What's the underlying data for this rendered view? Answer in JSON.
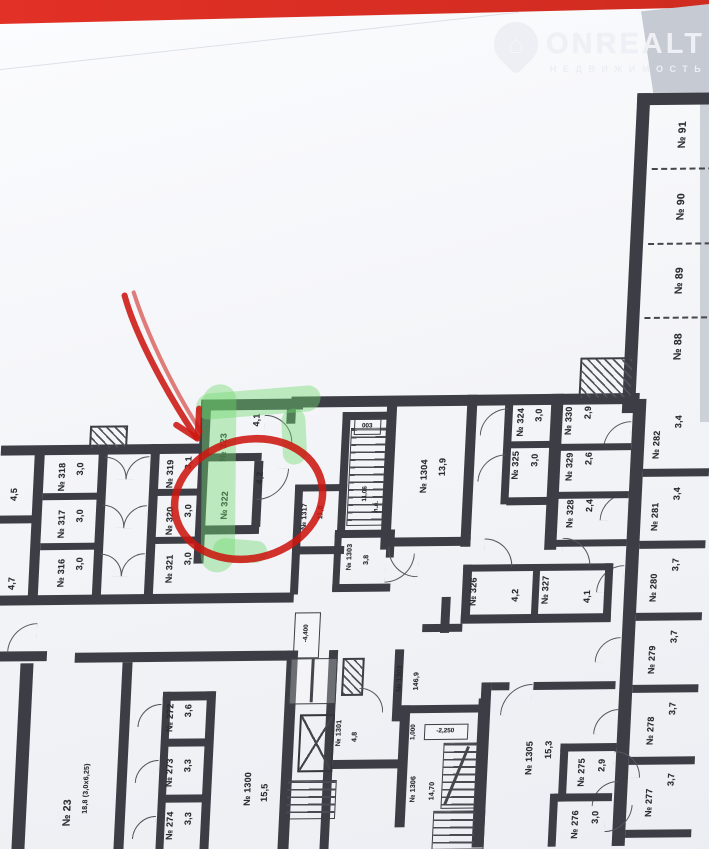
{
  "photo": {
    "top_strip_color": "#e23126",
    "background_color": "#c6cad2",
    "paper_color": "#f4f5f8"
  },
  "watermark": {
    "brand": "ONREALT",
    "subtitle": "НЕДВИЖИМОСТЬ"
  },
  "annotations": {
    "highlight_color": "#6fd96f",
    "marker_color": "#cc1710",
    "target_room": "№ 322"
  },
  "floorplan": {
    "rooms": {
      "r91": {
        "num": "№ 91"
      },
      "r90": {
        "num": "№ 90"
      },
      "r89": {
        "num": "№ 89"
      },
      "r88": {
        "num": "№ 88"
      },
      "r282": {
        "num": "№ 282",
        "area": "3,4"
      },
      "r281": {
        "num": "№ 281",
        "area": "3,4"
      },
      "r280": {
        "num": "№ 280",
        "area": "3,7"
      },
      "r279": {
        "num": "№ 279",
        "area": "3,7"
      },
      "r278": {
        "num": "№ 278",
        "area": "3,7"
      },
      "r277": {
        "num": "№ 277",
        "area": "3,7"
      },
      "r330": {
        "num": "№ 330",
        "area": "2,9"
      },
      "r329": {
        "num": "№ 329",
        "area": "2,6"
      },
      "r328": {
        "num": "№ 328",
        "area": "2,4"
      },
      "r324": {
        "num": "№ 324",
        "area": "3,0"
      },
      "r325": {
        "num": "№ 325",
        "area": "3,0"
      },
      "r326": {
        "num": "№ 326",
        "area": "4,2"
      },
      "r327": {
        "num": "№ 327",
        "area": "4,1"
      },
      "r323": {
        "num": "№ 323",
        "area": "4,1"
      },
      "r322": {
        "num": "№ 322",
        "area": "4,2"
      },
      "r319": {
        "num": "№ 319",
        "area": "3,1"
      },
      "r320": {
        "num": "№ 320",
        "area": "3,0"
      },
      "r321": {
        "num": "№ 321",
        "area": "3,0"
      },
      "r318": {
        "num": "№ 318",
        "area": "3,0"
      },
      "r317": {
        "num": "№ 317",
        "area": "3,0"
      },
      "r316": {
        "num": "№ 316",
        "area": "3,0"
      },
      "l45": {
        "area": "4,5"
      },
      "l47": {
        "area": "4,7"
      },
      "b1304": {
        "num": "№ 1304",
        "area": "13,9"
      },
      "b1317": {
        "num": "№ 1317",
        "area": "11,0"
      },
      "b1303": {
        "num": "№ 1303",
        "area": "3,8"
      },
      "b1300": {
        "num": "№ 1300",
        "area": "15,5"
      },
      "b1301": {
        "num": "№ 1301",
        "area": "4,8"
      },
      "b1302": {
        "num": "№ 1302",
        "area": "146,9"
      },
      "b1305": {
        "num": "№ 1305",
        "area": "15,3"
      },
      "b1306": {
        "num": "№ 1306",
        "area": "14,70"
      },
      "r23": {
        "num": "№ 23",
        "area": "18,8 (3,0х6,25)"
      },
      "redge": {
        "area": "17,5 (2,8х6,25)"
      },
      "r272": {
        "num": "№ 272",
        "area": "3,6"
      },
      "r273": {
        "num": "№ 273",
        "area": "3,3"
      },
      "r274": {
        "num": "№ 274",
        "area": "3,3"
      },
      "r275": {
        "num": "№ 275",
        "area": "2,9"
      },
      "r276": {
        "num": "№ 276",
        "area": "3,0"
      }
    },
    "marks": {
      "elev_top": "-4,400",
      "elev_stair": "-2,250",
      "elev_small": "1,000",
      "stair_area": "11,06",
      "stair_tag": "003",
      "lift_tag": "л.л."
    }
  }
}
